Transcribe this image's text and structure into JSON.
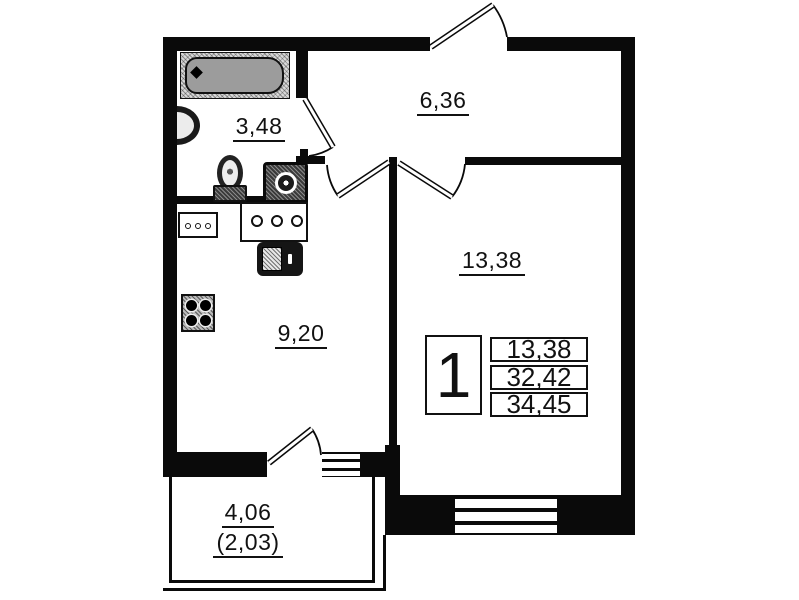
{
  "plan": {
    "rooms": {
      "bathroom": {
        "area": "3,48"
      },
      "hallway": {
        "area": "6,36"
      },
      "living_room": {
        "area": "13,38"
      },
      "kitchen": {
        "area": "9,20"
      },
      "balcony": {
        "area": "4,06",
        "area_coefficient": "(2,03)"
      }
    },
    "legend": {
      "rooms_count": "1",
      "living_area": "13,38",
      "area_without_balcony": "32,42",
      "total_area": "34,45"
    },
    "fixtures": [
      "bathtub",
      "wash-basin",
      "toilet",
      "washing-machine",
      "kitchen-sink-counter",
      "cabinet",
      "oven",
      "stove-4-burner"
    ],
    "doors": [
      "entrance-door",
      "bathroom-door",
      "kitchen-door",
      "living-room-door",
      "balcony-door"
    ],
    "windows": [
      "kitchen-window",
      "living-room-window"
    ],
    "colors": {
      "wall": "#000000",
      "background": "#ffffff",
      "bathtub": "#9c9c9c"
    }
  }
}
